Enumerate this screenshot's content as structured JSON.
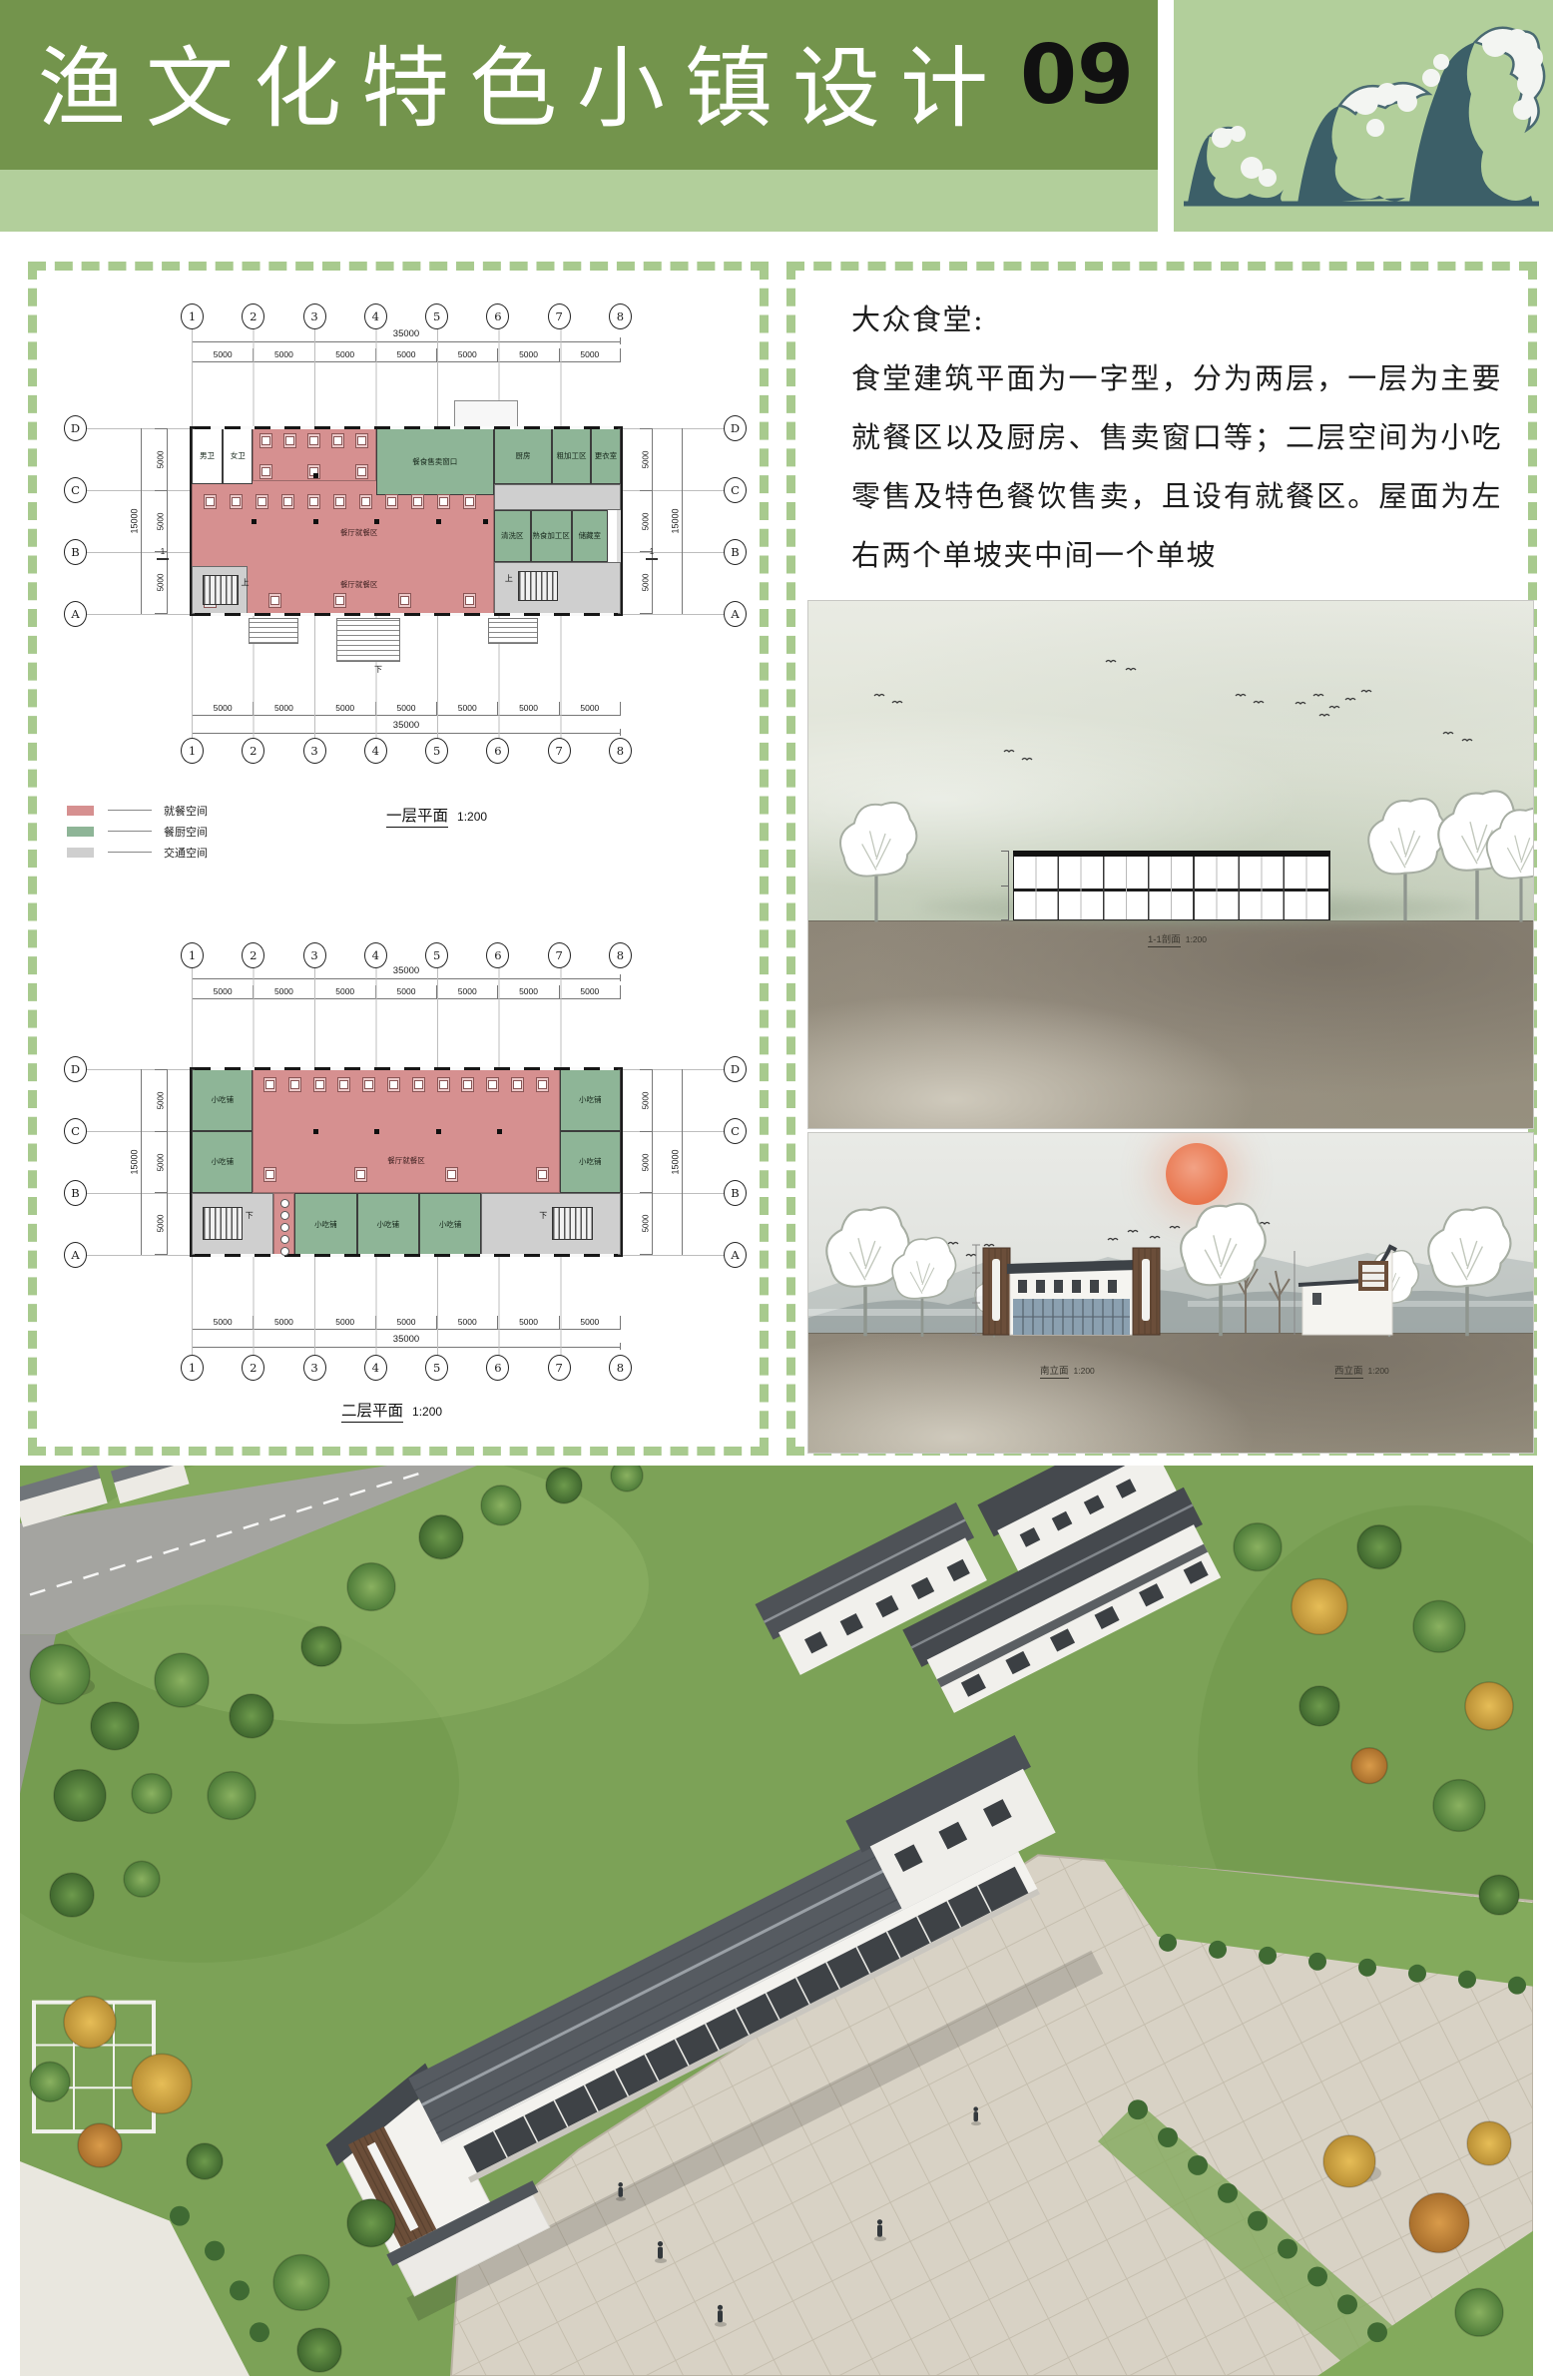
{
  "header": {
    "title": "渔文化特色小镇设计",
    "page_number": "09"
  },
  "colors": {
    "header_green": "#73944c",
    "header_light_green": "#b2cf9b",
    "wave_teal": "#3c5f68",
    "dash_border": "#a8ca8e",
    "dining_pink": "#d69090",
    "kitchen_green": "#8eb597",
    "circulation_gray": "#cfcfcf",
    "sun_orange": "#e8744c"
  },
  "notes": {
    "heading": "大众食堂:",
    "body": "食堂建筑平面为一字型，分为两层，一层为主要就餐区以及厨房、售卖窗口等；二层空间为小吃零售及特色餐饮售卖，且设有就餐区。屋面为左右两个单坡夹中间一个单坡"
  },
  "legend": {
    "items": [
      {
        "label": "就餐空间",
        "color": "#d69090"
      },
      {
        "label": "餐厨空间",
        "color": "#8eb597"
      },
      {
        "label": "交通空间",
        "color": "#cfcfcf"
      }
    ]
  },
  "grid": {
    "cols": [
      "1",
      "2",
      "3",
      "4",
      "5",
      "6",
      "7",
      "8"
    ],
    "rows": [
      "D",
      "C",
      "B",
      "A"
    ],
    "bays": [
      "5000",
      "5000",
      "5000",
      "5000",
      "5000",
      "5000",
      "5000"
    ],
    "total_width": "35000",
    "side_dims": [
      "5000",
      "5000",
      "5000"
    ],
    "total_height": "15000"
  },
  "floor1": {
    "title": "一层平面",
    "scale": "1:200",
    "section_mark": "1",
    "rooms": {
      "male_wc": "男卫",
      "female_wc": "女卫",
      "dining_a": "餐厅就餐区",
      "dining_b": "餐厅就餐区",
      "serving_window": "餐食售卖窗口",
      "kitchen": "厨房",
      "rough_prep": "粗加工区",
      "changing_room": "更衣室",
      "washing": "清洗区",
      "cooked_prep": "熟食加工区",
      "storage": "储藏室",
      "up": "上",
      "down": "下"
    }
  },
  "floor2": {
    "title": "二层平面",
    "scale": "1:200",
    "rooms": {
      "snack": "小吃铺",
      "dining": "餐厅就餐区",
      "down": "下"
    }
  },
  "renders": {
    "section": {
      "caption": "1-1剖面",
      "scale": "1:200"
    },
    "south_elevation": {
      "caption": "南立面",
      "scale": "1:200"
    },
    "side_elevation": {
      "caption": "西立面",
      "scale": "1:200"
    }
  }
}
